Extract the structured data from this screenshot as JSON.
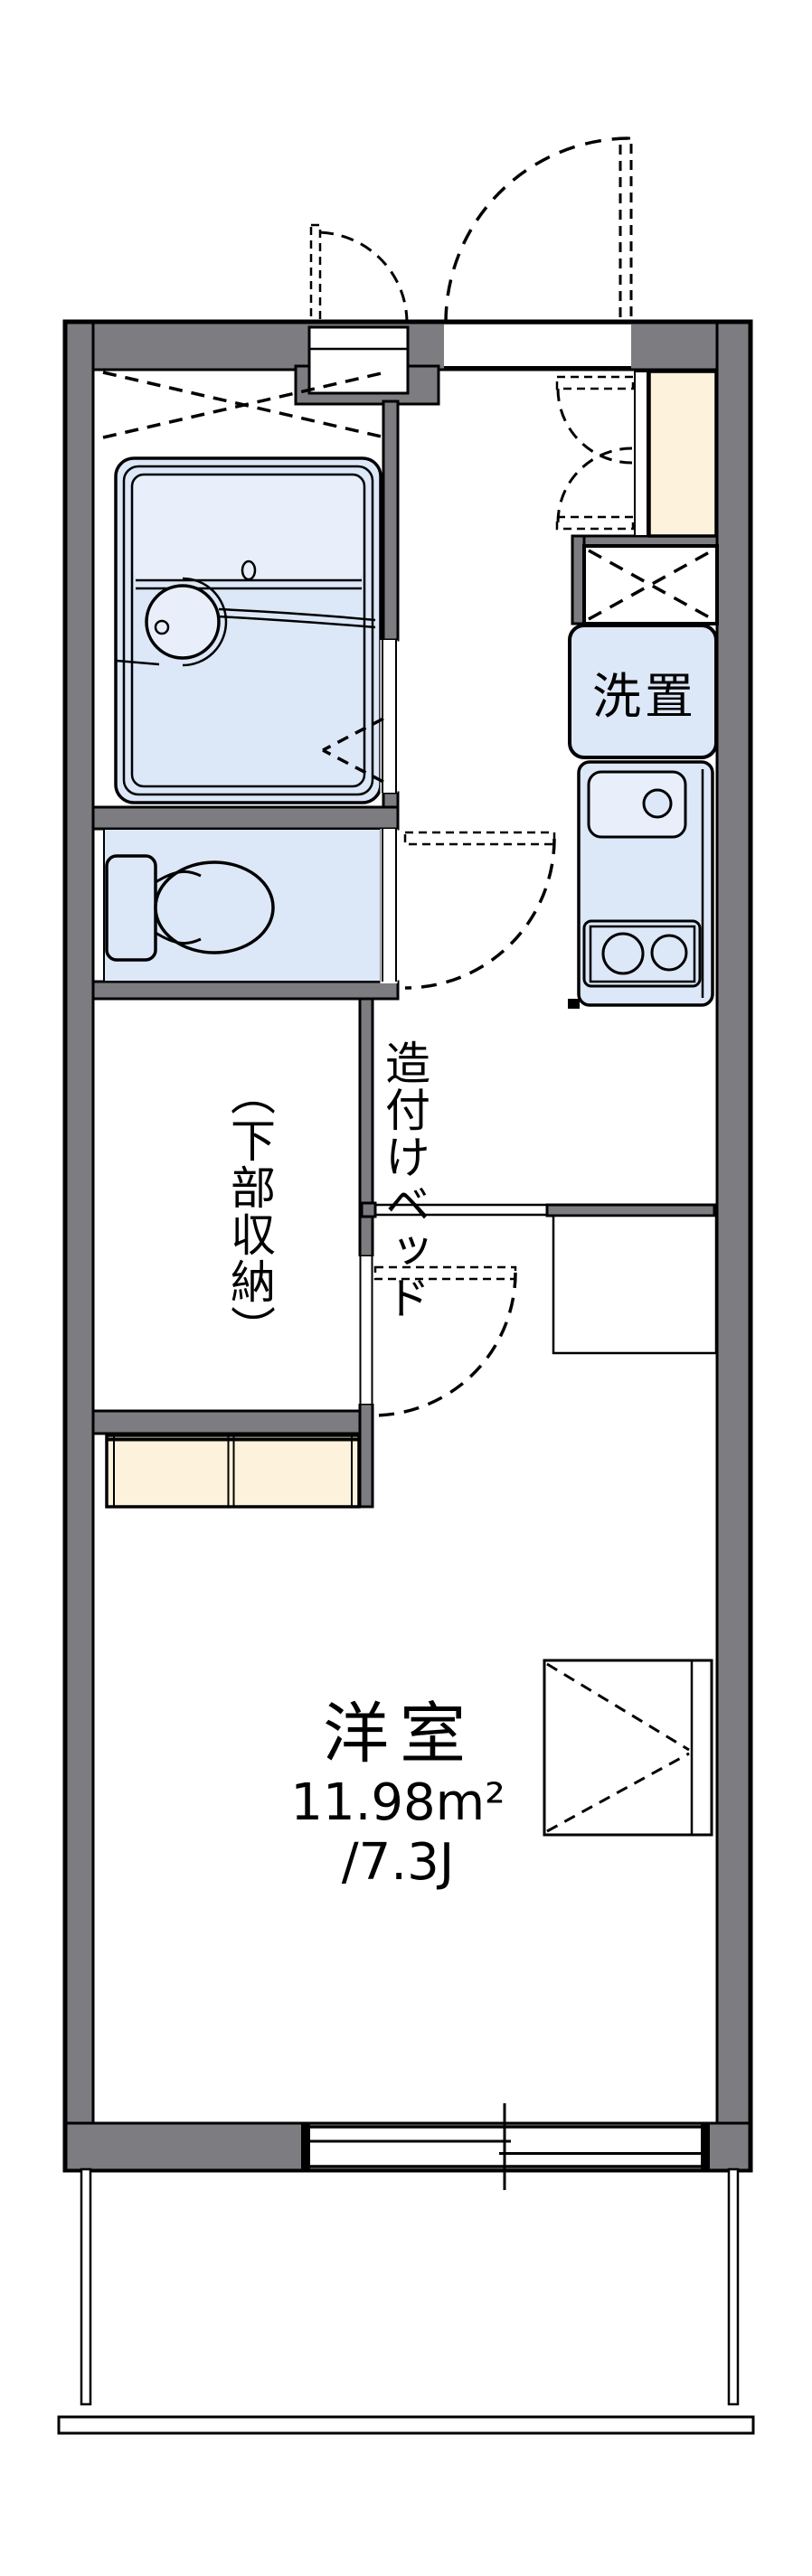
{
  "plan": {
    "labels": {
      "washer": "洗置",
      "bed_main": "造付けベッド",
      "bed_sub": "（下部収納）",
      "room": "洋室",
      "area": "11.98m²",
      "tatami": "/7.3J"
    },
    "colors": {
      "wall_gray": "#7c7c81",
      "fixture_blue": "#dce7f8",
      "fixture_blue_light": "#e8effb",
      "cabinet_cream": "#fdf3dc",
      "outline_black": "#000000",
      "background": "#ffffff"
    }
  }
}
